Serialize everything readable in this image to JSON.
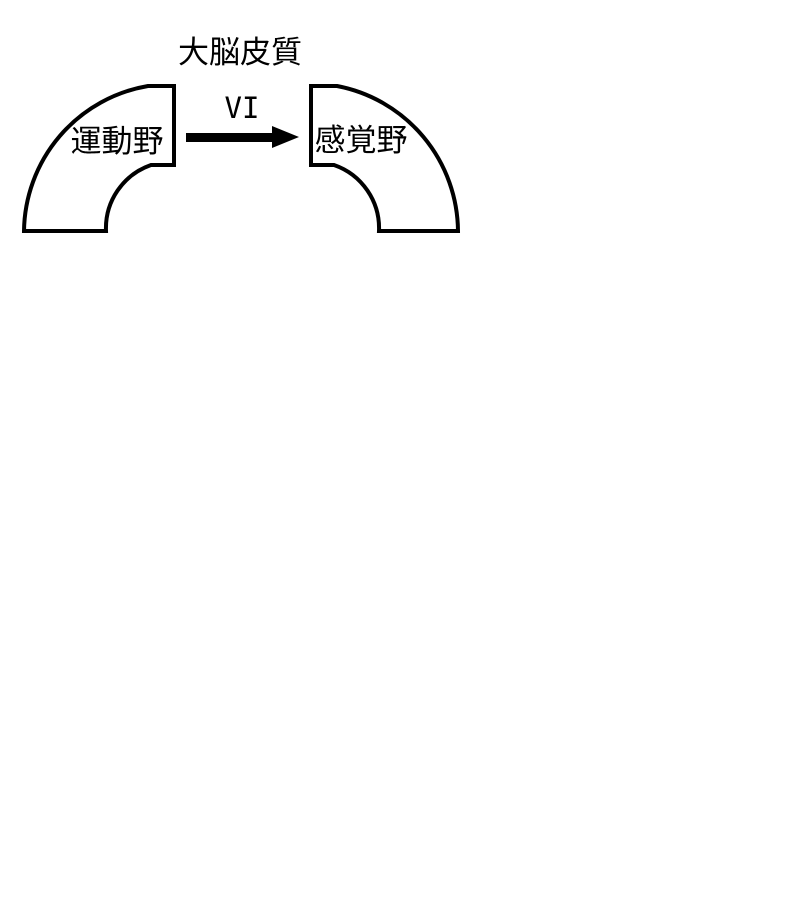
{
  "diagram": {
    "title": "大脳皮質",
    "pathway_label": "VI",
    "regions": [
      {
        "label": "運動野"
      },
      {
        "label": "感覚野"
      }
    ],
    "colors": {
      "stroke": "#000000",
      "fill": "#ffffff",
      "arrow": "#000000",
      "text": "#000000",
      "background": "#ffffff"
    }
  }
}
